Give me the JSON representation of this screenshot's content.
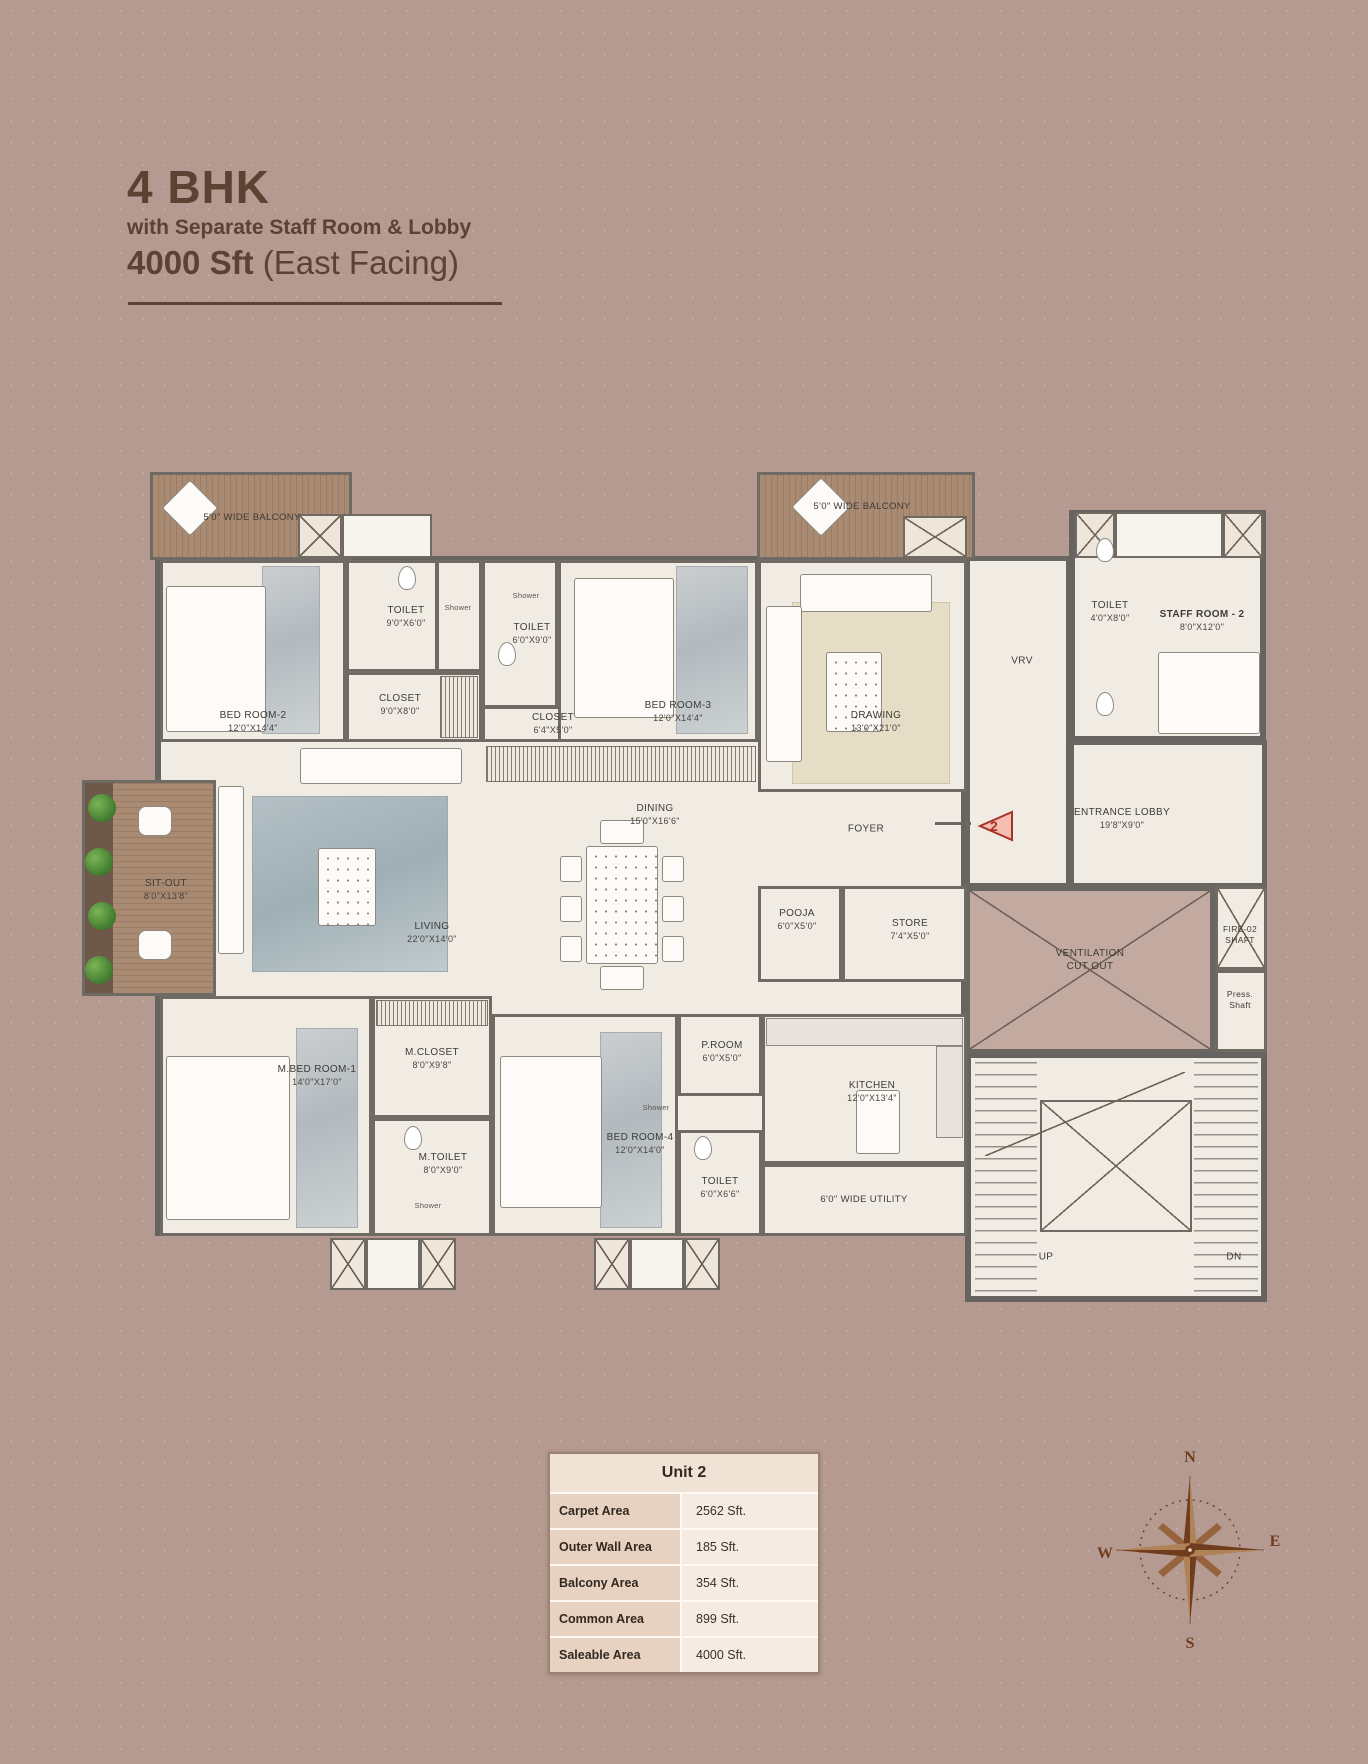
{
  "title": {
    "main": "4 BHK",
    "subtitle": "with Separate Staff Room & Lobby",
    "area_bold": "4000 Sft",
    "area_rest": " (East Facing)"
  },
  "plan": {
    "balcony_left": "5'0\" WIDE BALCONY",
    "balcony_right": "5'0\" WIDE BALCONY",
    "shower_label": "Shower",
    "unit_marker": "2",
    "stairs": {
      "up": "UP",
      "dn": "DN"
    },
    "rooms": {
      "bedroom2": {
        "name": "BED ROOM-2",
        "dims": "12'0\"X14'4\""
      },
      "toilet2": {
        "name": "TOILET",
        "dims": "9'0\"X6'0\""
      },
      "closet2": {
        "name": "CLOSET",
        "dims": "9'0\"X8'0\""
      },
      "toilet3": {
        "name": "TOILET",
        "dims": "6'0\"X9'0\""
      },
      "closet3": {
        "name": "CLOSET",
        "dims": "6'4\"X5'0\""
      },
      "bedroom3": {
        "name": "BED ROOM-3",
        "dims": "12'0\"X14'4\""
      },
      "drawing": {
        "name": "DRAWING",
        "dims": "13'0\"X21'0\""
      },
      "vrv": {
        "name": "VRV"
      },
      "toilet_staff": {
        "name": "TOILET",
        "dims": "4'0\"X8'0\""
      },
      "staff_room": {
        "name": "STAFF ROOM - 2",
        "dims": "8'0\"X12'0\""
      },
      "sit_out": {
        "name": "SIT-OUT",
        "dims": "8'0\"X13'8\""
      },
      "living": {
        "name": "LIVING",
        "dims": "22'0\"X14'0\""
      },
      "dining": {
        "name": "DINING",
        "dims": "15'0\"X16'6\""
      },
      "foyer": {
        "name": "FOYER"
      },
      "entrance_lobby": {
        "name": "ENTRANCE LOBBY",
        "dims": "19'8\"X9'0\""
      },
      "pooja": {
        "name": "POOJA",
        "dims": "6'0\"X5'0\""
      },
      "store": {
        "name": "STORE",
        "dims": "7'4\"X5'0\""
      },
      "ventilation": {
        "name": "VENTILATION",
        "name2": "CUT OUT"
      },
      "fire_shaft": {
        "name": "FIRE-02",
        "name2": "SHAFT"
      },
      "press_shaft": {
        "name": "Press.",
        "name2": "Shaft"
      },
      "m_bedroom1": {
        "name": "M.BED ROOM-1",
        "dims": "14'0\"X17'0\""
      },
      "m_closet": {
        "name": "M.CLOSET",
        "dims": "8'0\"X9'8\""
      },
      "m_toilet": {
        "name": "M.TOILET",
        "dims": "8'0\"X9'0\""
      },
      "bedroom4": {
        "name": "BED ROOM-4",
        "dims": "12'0\"X14'0\""
      },
      "p_room": {
        "name": "P.ROOM",
        "dims": "6'0\"X5'0\""
      },
      "toilet4": {
        "name": "TOILET",
        "dims": "6'0\"X6'6\""
      },
      "kitchen": {
        "name": "KITCHEN",
        "dims": "12'0\"X13'4\""
      },
      "utility": {
        "name": "6'0\" WIDE UTILITY"
      }
    }
  },
  "table": {
    "header": "Unit 2",
    "rows": [
      {
        "label": "Carpet Area",
        "value": "2562 Sft."
      },
      {
        "label": "Outer Wall Area",
        "value": "185 Sft."
      },
      {
        "label": "Balcony Area",
        "value": "354 Sft."
      },
      {
        "label": "Common Area",
        "value": "899 Sft."
      },
      {
        "label": "Saleable Area",
        "value": "4000 Sft."
      }
    ]
  },
  "compass": {
    "n": "N",
    "e": "E",
    "s": "S",
    "w": "W"
  },
  "colors": {
    "background": "#b49a90",
    "title_text": "#5c4233",
    "wall": "#6f6a64",
    "floor": "#f1ece3",
    "deck_wood": "#a3836f",
    "marker_red": "#a93228",
    "table_header_bg": "#f0e2d5",
    "table_label_bg": "#e7d1c1",
    "table_value_bg": "#f5ebe2",
    "compass_brown": "#6f3c1e"
  }
}
